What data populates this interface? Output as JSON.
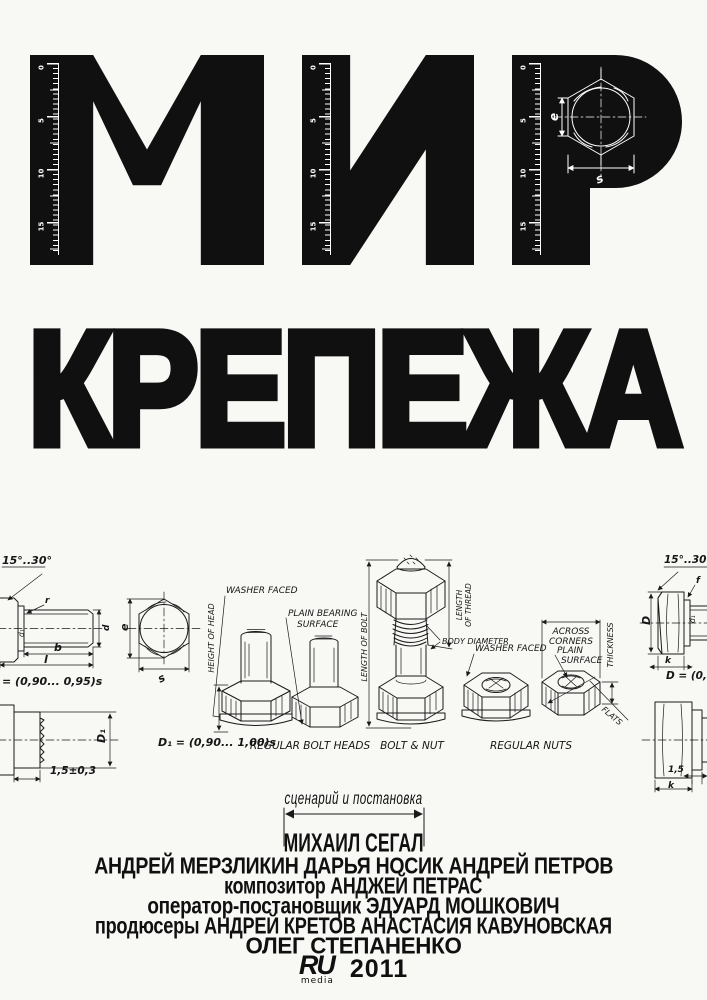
{
  "poster": {
    "title_line1": "МИР",
    "title_line2": "КРЕПЕЖА",
    "ruler_numbers": [
      "0",
      "5",
      "10",
      "15"
    ]
  },
  "colors": {
    "ink": "#101010",
    "paper": "#f8f8f5"
  },
  "hex_inset": {
    "dim_e": "e",
    "dim_s": "s"
  },
  "diagram": {
    "left_bolt": {
      "angle": "15°..30°",
      "r": "r",
      "d1": "d₁",
      "d": "d",
      "b": "b",
      "l": "l",
      "formula": "= (0,90... 0,95)s"
    },
    "hex_head": {
      "e": "e",
      "s": "s"
    },
    "height_of_head": "HEIGHT OF HEAD",
    "washer_faced_bolt": "WASHER FACED",
    "plain_bearing_line1": "PLAIN BEARING",
    "plain_bearing_line2": "SURFACE",
    "caption_bolt_heads": "REGULAR BOLT HEADS",
    "length_of_bolt": "LENGTH OF BOLT",
    "length_of_thread_line1": "LENGTH",
    "length_of_thread_line2": "OF THREAD",
    "body_diameter": "BODY DIAMETER",
    "caption_bolt_nut": "BOLT & NUT",
    "washer_faced_nut": "WASHER FACED",
    "plain_surface_line1": "PLAIN",
    "plain_surface_line2": "SURFACE",
    "across_line1": "ACROSS",
    "across_line2": "CORNERS",
    "thickness": "THICKNESS",
    "flats": "FLATS",
    "caption_nuts": "REGULAR NUTS",
    "right_bolt": {
      "angle": "15°..30°",
      "D": "D",
      "d1": "d₁",
      "f": "f",
      "k": "k",
      "formula": "D = (0,90"
    },
    "bottom_left": {
      "D1": "D₁",
      "tol": "1,5±0,3",
      "formula": "D₁ = (0,90... 1,00)s"
    },
    "bottom_right": {
      "tol": "1,5",
      "k": "k"
    }
  },
  "credits": {
    "role_director": "сценарий и постановка",
    "director": "МИХАИЛ СЕГАЛ",
    "cast": [
      "АНДРЕЙ МЕРЗЛИКИН",
      "ДАРЬЯ НОСИК",
      "АНДРЕЙ ПЕТРОВ"
    ],
    "composer_line": "композитор АНДЖЕЙ ПЕТРАС",
    "dop_line": "оператор-постановщик ЭДУАРД МОШКОВИЧ",
    "producers_line": "продюсеры АНДРЕЙ КРЕТОВ АНАСТАСИЯ КАВУНОВСКАЯ",
    "producer_line2": "ОЛЕГ СТЕПАНЕНКО",
    "year": "2011",
    "logo_text": "RU",
    "logo_sub": "media"
  }
}
